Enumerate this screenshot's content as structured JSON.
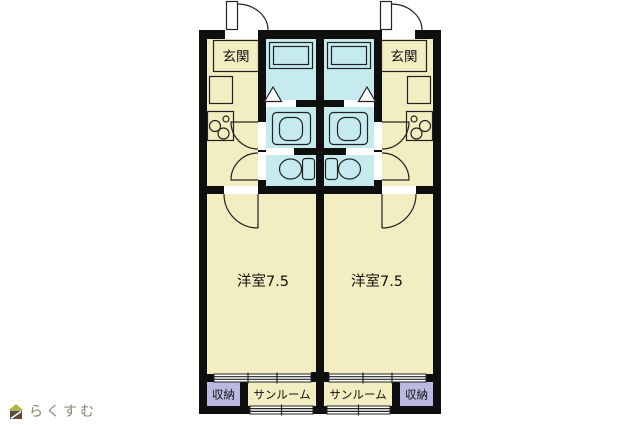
{
  "colors": {
    "background": "#ffffff",
    "wall": "#0f0f0f",
    "line": "#222222",
    "room_cream": "#f2eec2",
    "wet_cyan": "#c6ebef",
    "storage_lavender": "#b9b9e2",
    "label_text": "#111111",
    "logo_text": "#8c8272",
    "logo_roof": "#a4bd31",
    "logo_body": "#5f4b39"
  },
  "units": {
    "left": {
      "entrance_label": "玄関",
      "room_label": "洋室7.5",
      "sunroom_label": "サンルーム",
      "storage_label": "収納"
    },
    "right": {
      "entrance_label": "玄関",
      "room_label": "洋室7.5",
      "sunroom_label": "サンルーム",
      "storage_label": "収納"
    }
  },
  "symbols": {
    "entrance_door": "swing-door-icon",
    "interior_door": "swing-door-icon",
    "bath_door": "folding-door-triangle-icon",
    "bathtub": "bathtub-icon",
    "washbasin": "washbasin-icon",
    "toilet": "toilet-icon",
    "stove": "two-burner-stove-icon",
    "window": "double-line-window-icon"
  },
  "logo": {
    "text": "らくすむ"
  }
}
